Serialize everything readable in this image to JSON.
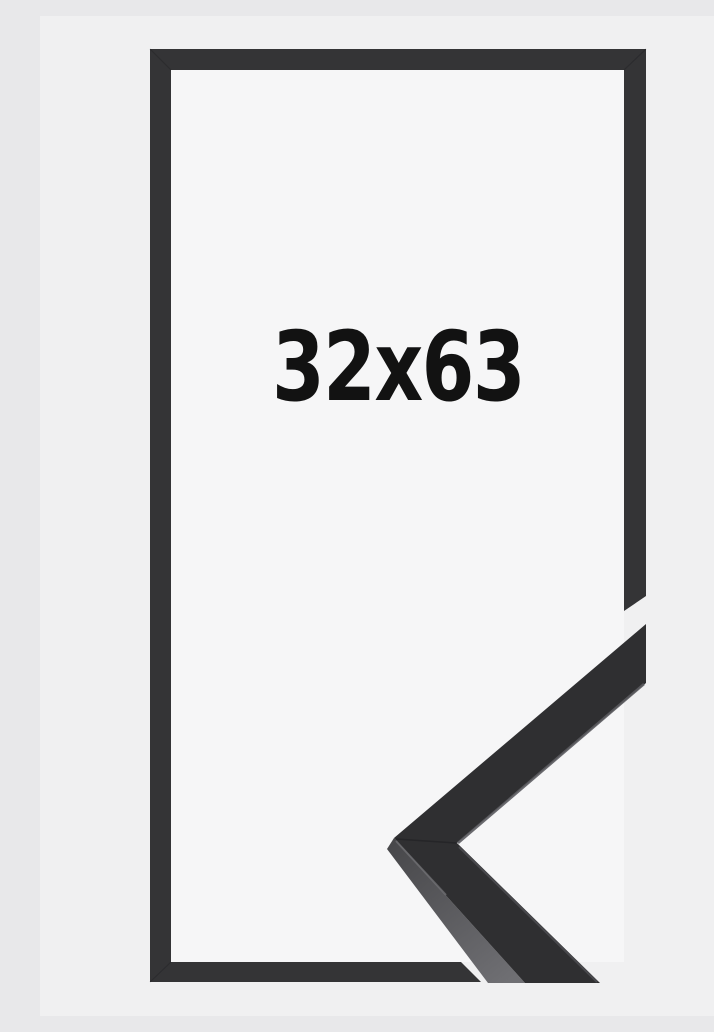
{
  "product": {
    "size_label": "32x63"
  },
  "colors": {
    "background": "#f0f0f1",
    "frame_interior": "#f6f6f7",
    "frame": "#343436",
    "corner_face": "#2f2f31",
    "corner_side_dark": "#47474a",
    "corner_side_light": "#6f6f73",
    "edge_highlight": "#5b5b5f",
    "edge_highlight_soft": "#525256",
    "seam": "#1e1e20",
    "label_text": "#121212"
  }
}
